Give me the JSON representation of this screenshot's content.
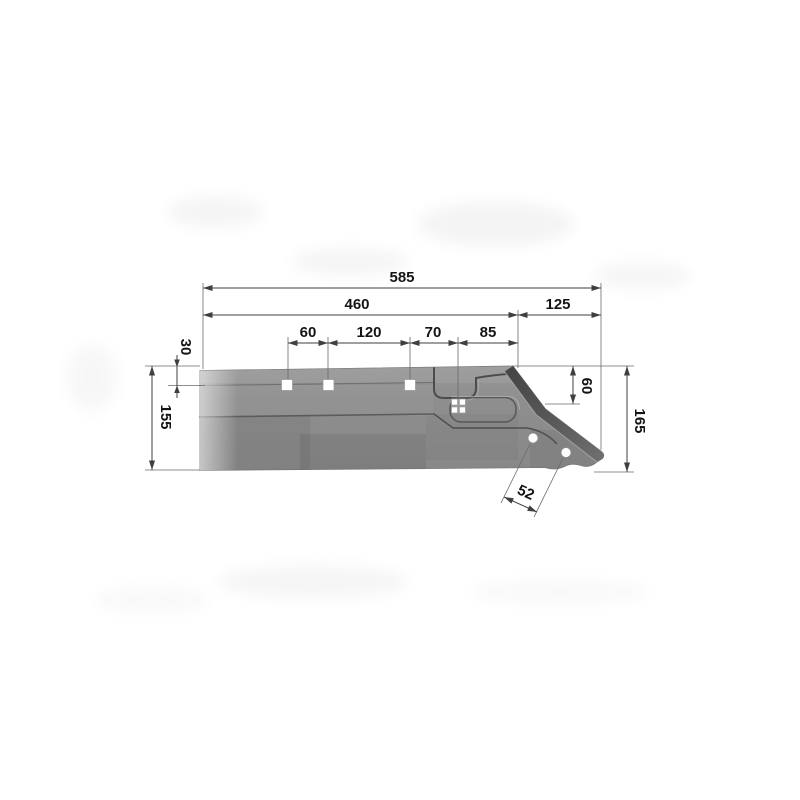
{
  "drawing": {
    "kind": "technical-drawing",
    "view": "side-view-with-dimensions"
  },
  "dimensions": {
    "overall_length": "585",
    "rear_length": "460",
    "tip_length": "125",
    "hole_gap_1": "60",
    "hole_gap_2": "120",
    "hole_gap_3": "70",
    "hole_gap_4": "85",
    "top_edge_offset": "30",
    "rear_height": "155",
    "tip_edge_drop": "60",
    "overall_height": "165",
    "tip_hole_pitch": "52"
  },
  "colors": {
    "background": "#ffffff",
    "body_gray": "#8e8e8e",
    "bevel_dark_gray": "#4f4f4f",
    "hole_white": "#ffffff",
    "dimension_line": "#3f3f3f",
    "label_text": "#141414"
  }
}
